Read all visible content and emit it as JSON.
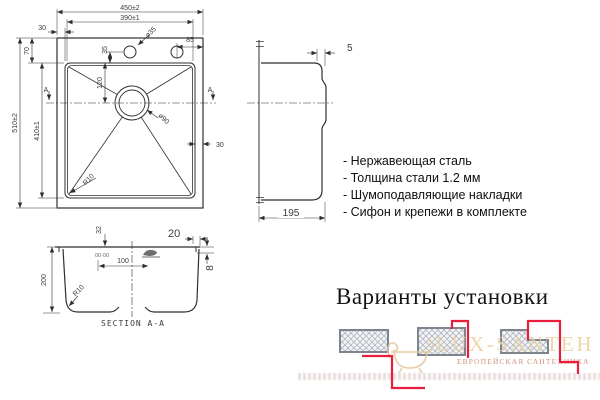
{
  "plan_view": {
    "section_marker_left": "A",
    "section_marker_right": "A",
    "dims": {
      "overall_width": "450±2",
      "bowl_width": "390±1",
      "rim_left": "30",
      "hole_diameter": "ø35",
      "hole_edge_offset": "85",
      "rim_top": "70",
      "hole_bowl_offset": "35",
      "drain_offset": "120",
      "drain_diameter": "ø90",
      "rim_right": "30",
      "corner_radius": "R10",
      "overall_depth": "510±2",
      "bowl_depth": "410±1"
    }
  },
  "side_view": {
    "dims": {
      "rim_thickness": "5",
      "base_width": "195"
    }
  },
  "features": {
    "items": [
      "- Нержавеющая сталь",
      "- Толщина стали 1.2 мм",
      "- Шумоподавляющие накладки",
      "- Сифон и крепежи в комплекте"
    ]
  },
  "section_view": {
    "title": "SECTION A-A",
    "stamp": "00·00",
    "dims": {
      "flange_drop": "32",
      "flange_width": "20",
      "flange_height": "8",
      "bowl_height": "200",
      "drain_offset": "100",
      "corner_radius": "R10"
    }
  },
  "installation": {
    "title": "Варианты установки"
  },
  "watermark": {
    "brand": "LUX-SANTEH",
    "subtitle": "ЕВРОПЕЙСКАЯ САНТЕХНИКА"
  },
  "colors": {
    "line": "#2f2f2f",
    "red_accent": "#e81e3c",
    "watermark_gold": "#edd2a6"
  }
}
